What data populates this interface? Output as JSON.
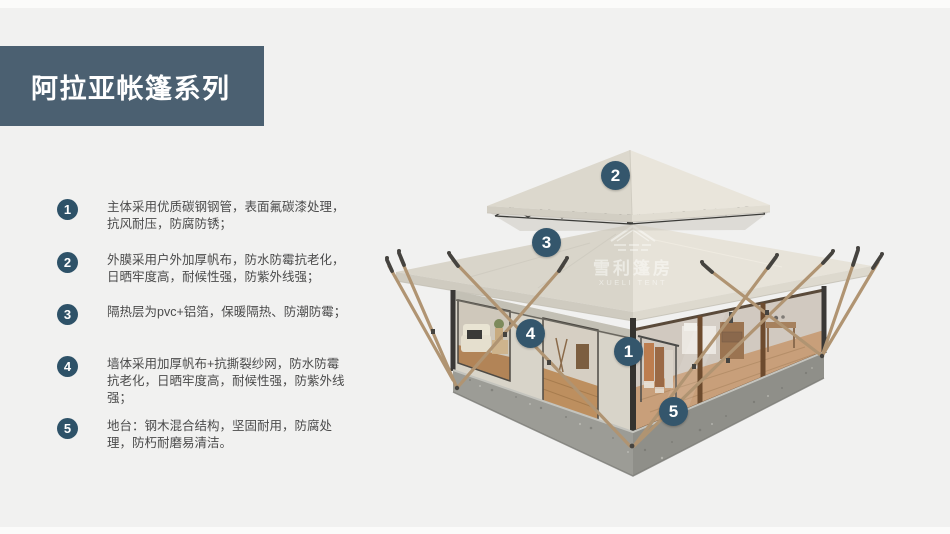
{
  "header": {
    "title": "阿拉亚帐篷系列"
  },
  "features": [
    {
      "num": "1",
      "text": "主体采用优质碳钢钢管，表面氟碳漆处理，抗风耐压，防腐防锈；"
    },
    {
      "num": "2",
      "text": "外膜采用户外加厚帆布，防水防霉抗老化，日晒牢度高，耐候性强，防紫外线强；"
    },
    {
      "num": "3",
      "text": "隔热层为pvc+铝箔，保暖隔热、防潮防霉；"
    },
    {
      "num": "4",
      "text": "墙体采用加厚帆布+抗撕裂纱网，防水防霉抗老化，日晒牢度高，耐候性强，防紫外线强；"
    },
    {
      "num": "5",
      "text": "地台：钢木混合结构，坚固耐用，防腐处理，防朽耐磨易清洁。"
    }
  ],
  "diagram": {
    "badges": [
      "1",
      "2",
      "3",
      "4",
      "5"
    ],
    "watermark": {
      "cn": "雪利篷房",
      "en": "XUELI TENT"
    }
  },
  "colors": {
    "accent": "#34566c",
    "header_bg": "#4b6071",
    "page_bg": "#f1f1f0",
    "roof_light": "#e8e4da",
    "roof_dark": "#d9d5ca",
    "base_gray": "#9c9c96",
    "pole_tan": "#b09472"
  }
}
